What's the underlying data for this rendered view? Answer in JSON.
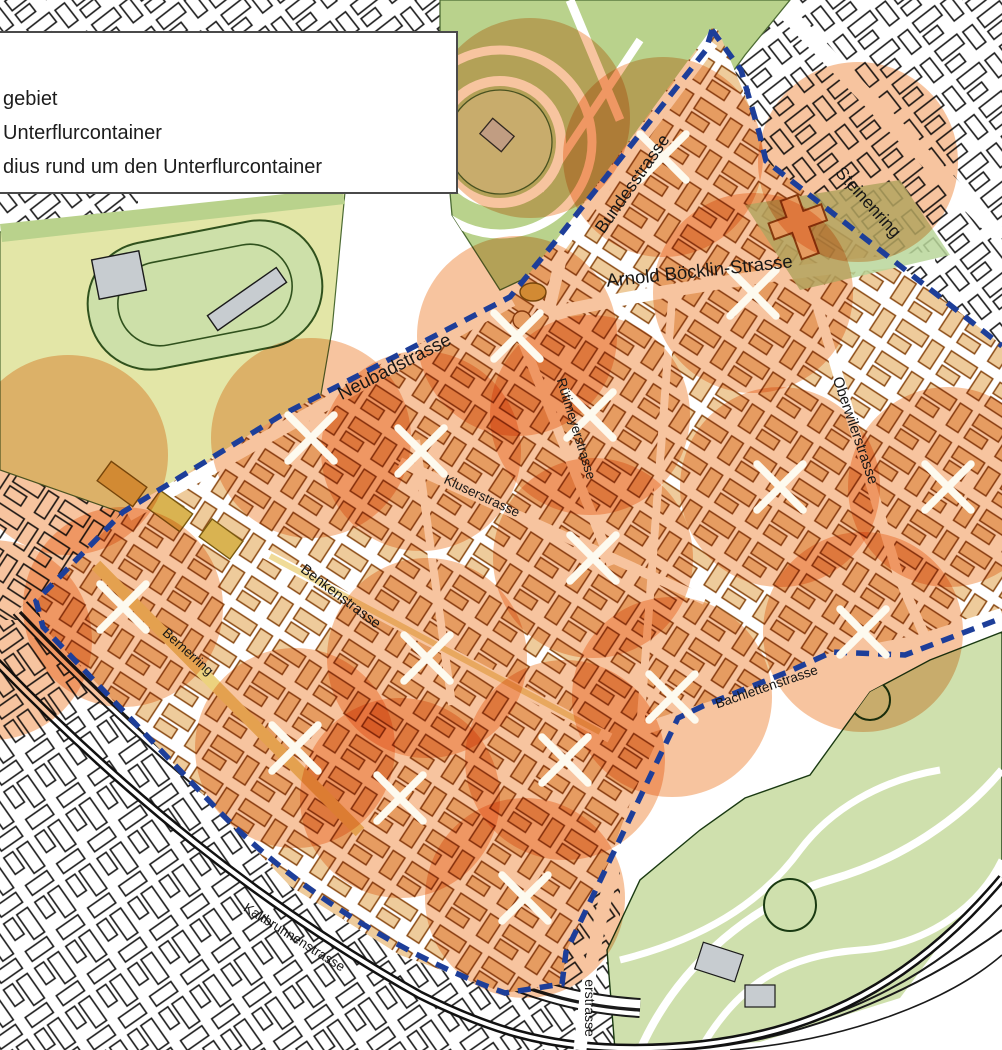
{
  "legend": {
    "line1": "gebiet",
    "line2": "Unterflurcontainer",
    "line3": "dius rund um den Unterflurcontainer"
  },
  "streets": {
    "bundesstrasse": "Bundesstrasse",
    "steinenring": "Steinenring",
    "arnold_boecklin": "Arnold Böcklin-Strasse",
    "neubadstrasse": "Neubadstrasse",
    "ruetimeyerstrasse": "Rütimeyerstrasse",
    "oberwilerstrasse": "Oberwilerstrasse",
    "kluserstrasse": "Kluserstrasse",
    "benkenstrasse": "Benkenstrasse",
    "bernerring": "Bernerring",
    "bachlettenstrasse": "Bachlettenstrasse",
    "kaltbrunnenstrasse": "Kaltbrunnenstrasse",
    "erstrasse": "erstrasse"
  },
  "colors": {
    "circle_orange": "#ed7d2a",
    "boundary_blue": "#1d3e99",
    "marker_white": "#fdfaef",
    "pilot_building": "#eecb9b",
    "pilot_building_outline": "#8a4a14",
    "outside_outline": "#1a1a1a",
    "park_green": "#b9d28c",
    "park_light_green": "#cfe0ad",
    "field_yellow_green": "#e3e6a7",
    "gray_building": "#c7ccd0",
    "mustard": "#d9b351",
    "street_yellow": "#ecd27e"
  },
  "map": {
    "radius_px": 100,
    "containers": [
      [
        663,
        157
      ],
      [
        753,
        293
      ],
      [
        517,
        336
      ],
      [
        311,
        438
      ],
      [
        421,
        451
      ],
      [
        590,
        415
      ],
      [
        780,
        487
      ],
      [
        948,
        487
      ],
      [
        123,
        607
      ],
      [
        427,
        658
      ],
      [
        593,
        558
      ],
      [
        863,
        632
      ],
      [
        672,
        697
      ],
      [
        295,
        748
      ],
      [
        400,
        798
      ],
      [
        565,
        760
      ],
      [
        525,
        898
      ]
    ],
    "extra_circles": [
      [
        530,
        118
      ],
      [
        858,
        162
      ],
      [
        68,
        455
      ],
      [
        -8,
        640
      ]
    ]
  }
}
